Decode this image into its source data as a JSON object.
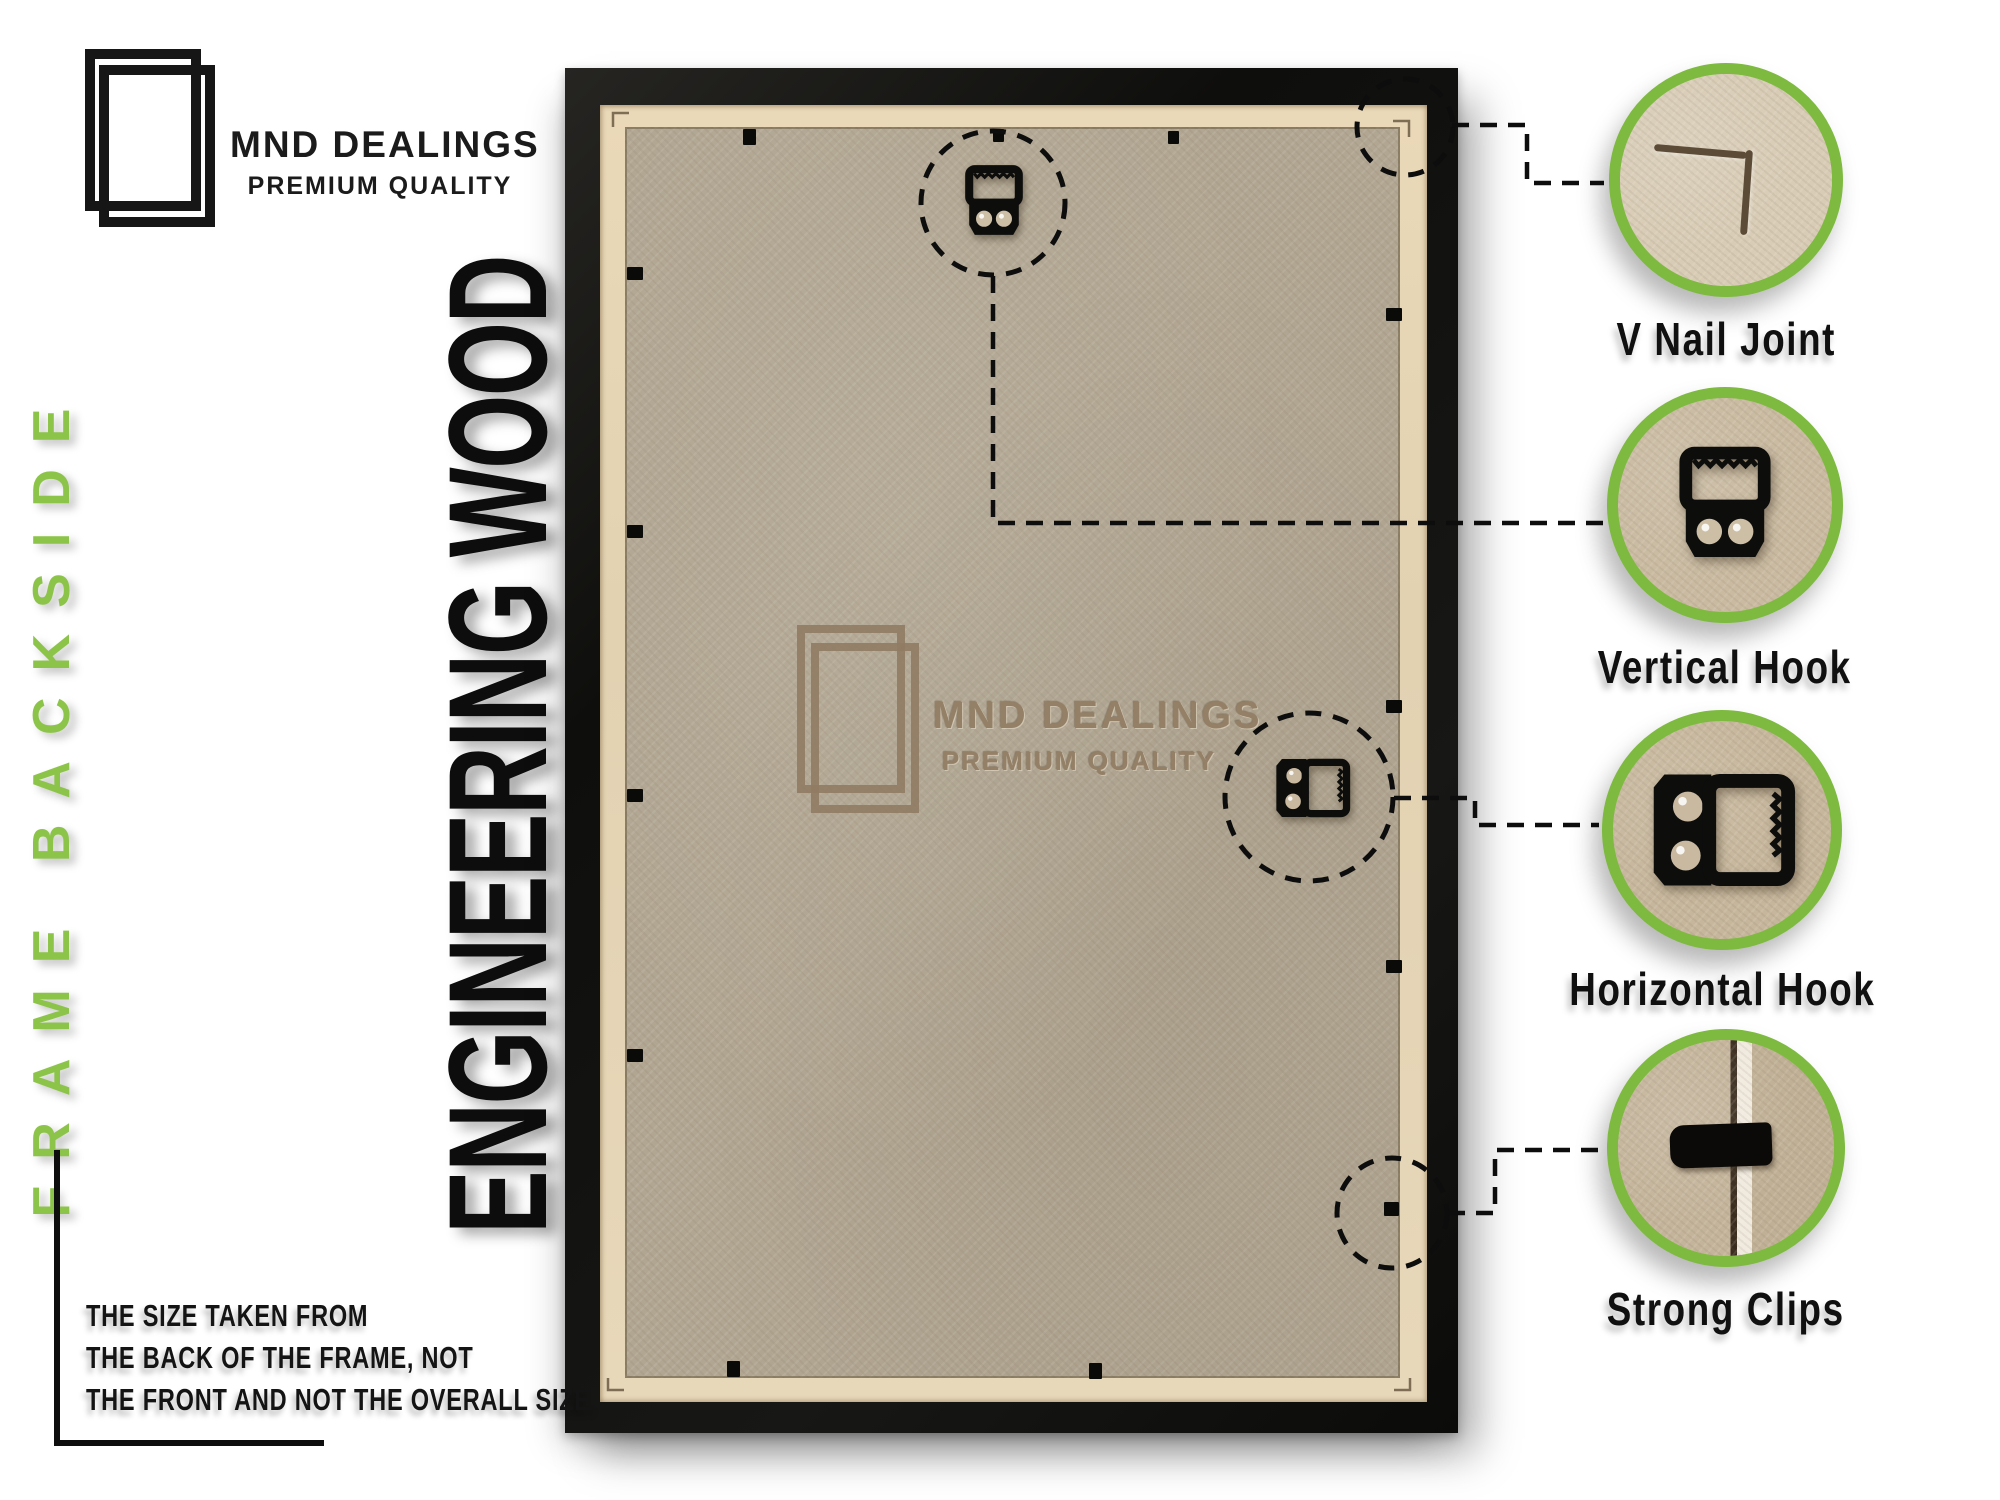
{
  "brand": {
    "name": "MND DEALINGS",
    "tagline": "PREMIUM QUALITY"
  },
  "labels": {
    "side": "FRAME BACKSIDE",
    "material": "ENGINEERING WOOD"
  },
  "watermark": {
    "name": "MND DEALINGS",
    "tagline": "PREMIUM QUALITY"
  },
  "callouts": [
    {
      "label": "V Nail Joint",
      "icon": "v-nail-joint-photo"
    },
    {
      "label": "Vertical Hook",
      "icon": "vertical-hook-icon"
    },
    {
      "label": "Horizontal Hook",
      "icon": "horizontal-hook-icon"
    },
    {
      "label": "Strong Clips",
      "icon": "strong-clip-photo"
    }
  ],
  "note": {
    "lines": [
      "THE SIZE TAKEN FROM",
      "THE BACK OF THE FRAME, NOT",
      "THE FRONT AND NOT THE OVERALL SIZE."
    ]
  },
  "colors": {
    "accent_green": "#7dba3f",
    "side_label_green": "#8cc449",
    "frame_black": "#141412",
    "board_tan": "#b1a692",
    "lip_tan": "#e7d7b7",
    "watermark_brown": "#937e65",
    "text_black": "#111111"
  }
}
